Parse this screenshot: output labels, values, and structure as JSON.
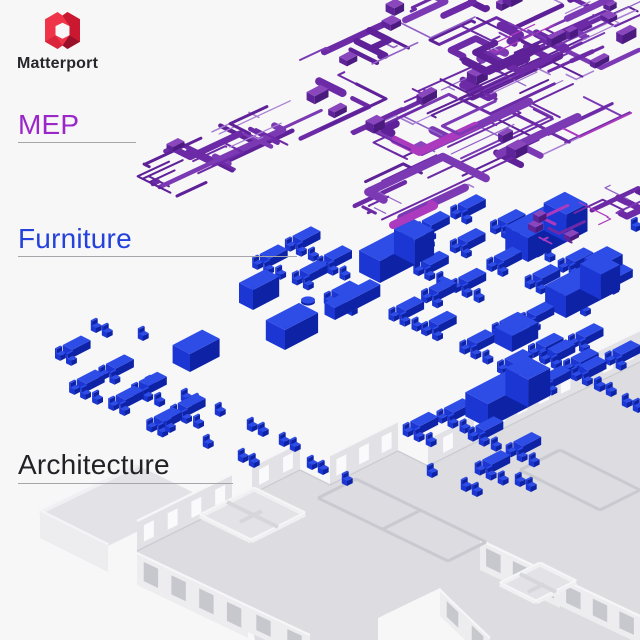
{
  "brand": {
    "name": "Matterport"
  },
  "layers": [
    {
      "id": "mep",
      "label": "MEP",
      "color": "#9B27C9"
    },
    {
      "id": "furniture",
      "label": "Furniture",
      "color": "#2442DB"
    },
    {
      "id": "architecture",
      "label": "Architecture",
      "color": "#212126"
    }
  ],
  "colors": {
    "background": "#F7F7F8",
    "leader_line": "#A5A5AA",
    "logo_red": "#EF3349",
    "logo_red_dark": "#C9182F",
    "logo_red_deep": "#99102A",
    "brand_text": "#26262B",
    "mep_palette": [
      "#6C2AA6",
      "#7B39B4",
      "#5E2197",
      "#9160C5",
      "#A87FD3",
      "#AC3ABF"
    ],
    "furniture_palette": {
      "top": "#2E4DE7",
      "left": "#1B36D2",
      "right": "#0E22A6"
    },
    "arch_palette": {
      "floor": "#DCDCE1",
      "wall": "#E2E2E6",
      "wallCap": "#F6F6F8",
      "facade": "#EDEDF0",
      "glassDark": "#C7C7CE",
      "glassLight": "#FAFAFC",
      "inner": "#C9C9CF",
      "edge": "#CCCCD2",
      "roomFloor": "#E3E3E7",
      "roomWall": "#F0F0F3",
      "partition": "#D6D6DB"
    }
  }
}
